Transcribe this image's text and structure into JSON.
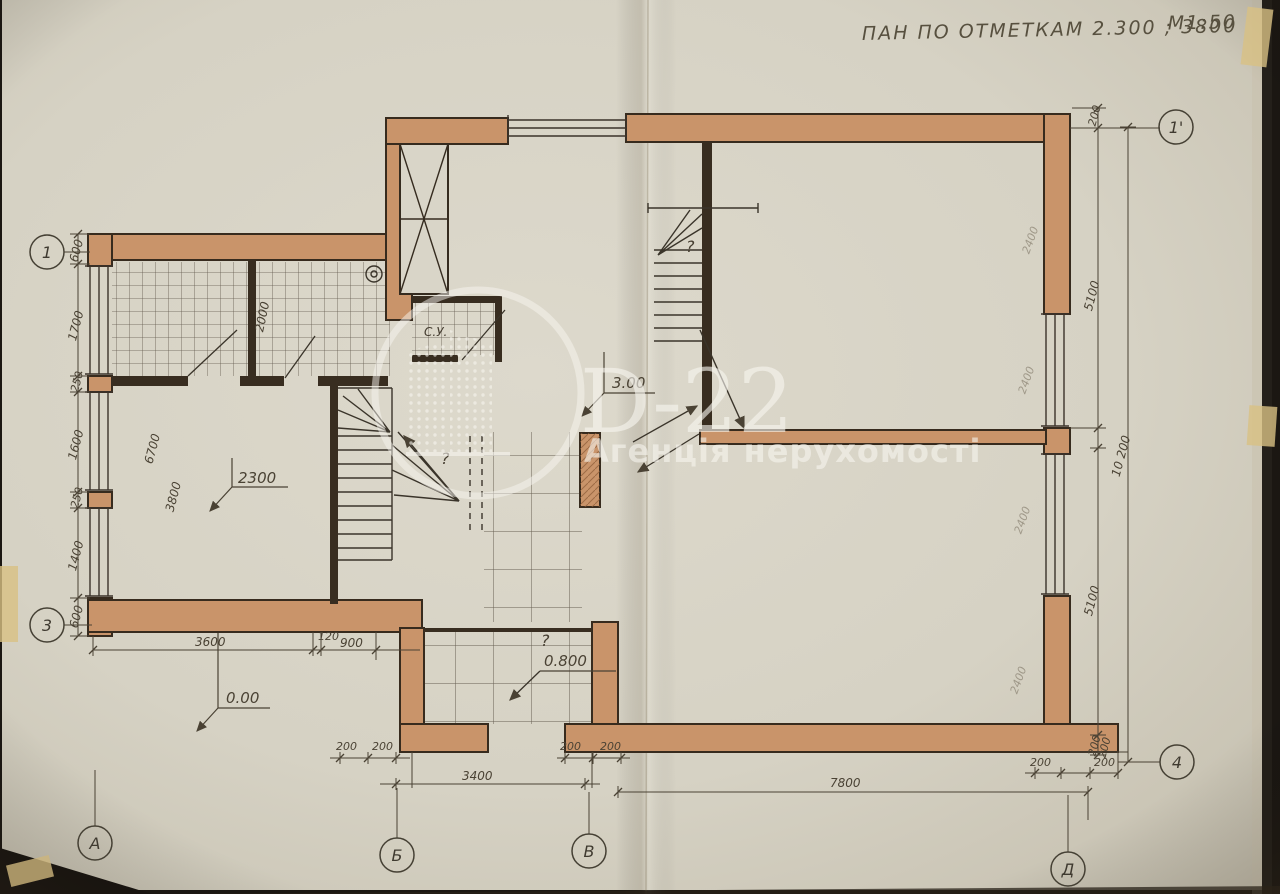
{
  "title": {
    "text": "ПАН ПО ОТМЕТКАМ 2.300 ; 3800",
    "scale": "М1:50"
  },
  "watermark": {
    "brand": "D-22",
    "subtitle": "Агенція нерухомості"
  },
  "axes": {
    "left_top": "1",
    "left_bottom": "3",
    "bottom_a": "А",
    "bottom_b": "Б",
    "bottom_v": "В",
    "bottom_d": "Д",
    "right_top": "1'",
    "right_bottom": "4"
  },
  "dims": {
    "left_chain": [
      "600",
      "1700",
      "250",
      "1600",
      "250",
      "1400",
      "600"
    ],
    "interior": {
      "top_room": "2000",
      "hall": "6700",
      "room": "3800"
    },
    "bottom_left": [
      "3600",
      "120",
      "900"
    ],
    "bottom_center": {
      "smalls": [
        "200",
        "200",
        "200",
        "200"
      ],
      "span": "3400"
    },
    "bottom_right": {
      "span": "7800",
      "smalls": [
        "200",
        "200",
        "200"
      ]
    },
    "right": {
      "top_small": "200",
      "upper": "5100",
      "total": "10 200",
      "lower": "5100",
      "bottom_small": "200"
    },
    "right_interior": [
      "2400",
      "2400",
      "2400",
      "2400"
    ]
  },
  "elevations": {
    "room": "2300",
    "ground": "0.00",
    "porch": "0.800",
    "stair": "3.00"
  },
  "labels": {
    "bathroom": "С.У."
  },
  "annotations": {
    "question": "?"
  },
  "colors": {
    "wall_fill": "#c9946a",
    "ink": "#372b1e",
    "dim_line": "#4a4234",
    "paper": "#d6d2c4",
    "watermark": "#f7f5ef"
  }
}
